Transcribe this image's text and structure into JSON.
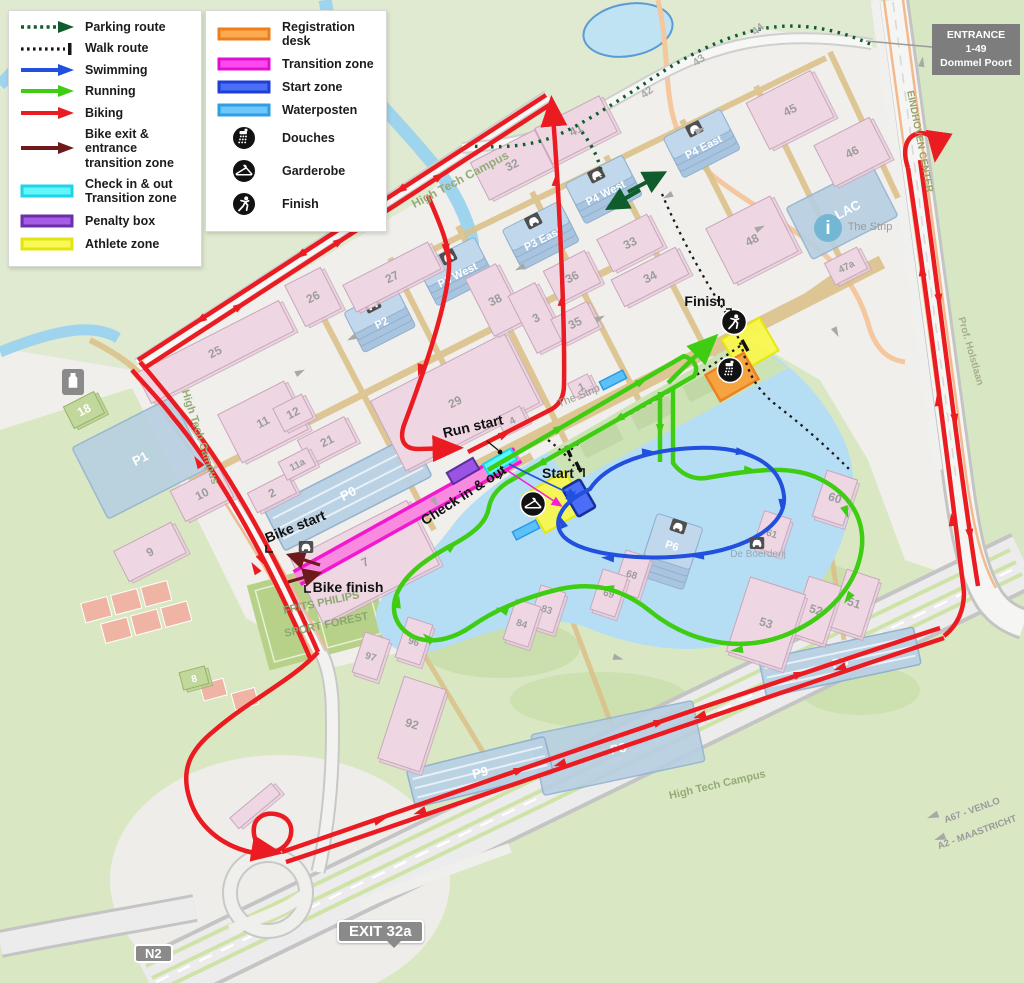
{
  "legend_left": {
    "items": [
      {
        "label": "Parking route",
        "sw": "dotted-arrow",
        "color": "#0f5c2d"
      },
      {
        "label": "Walk route",
        "sw": "dotted-bar",
        "color": "#161616"
      },
      {
        "label": "Swimming",
        "sw": "arrow",
        "color": "#2050dd"
      },
      {
        "label": "Running",
        "sw": "arrow",
        "color": "#3ecd12"
      },
      {
        "label": "Biking",
        "sw": "arrow",
        "color": "#ea1c22"
      },
      {
        "label": "Bike exit & entrance",
        "label2": "transition zone",
        "sw": "arrow",
        "color": "#6e1a1c"
      },
      {
        "label": "Check in & out",
        "label2": "Transition zone",
        "sw": "bar",
        "color": "#63f6f9",
        "border": "#1fd3ea"
      },
      {
        "label": "Penalty box",
        "sw": "bar",
        "color": "#a55ce6",
        "border": "#6b2fa8"
      },
      {
        "label": "Athlete zone",
        "sw": "bar",
        "color": "#f9f955",
        "border": "#e4e410"
      }
    ]
  },
  "legend_right": {
    "items": [
      {
        "label": "Registration desk",
        "sw": "bar",
        "color": "#fbaa4e",
        "border": "#f07d1d"
      },
      {
        "label": "Transition zone",
        "sw": "bar",
        "color": "#fb49ef",
        "border": "#e00fd0"
      },
      {
        "label": "Start zone",
        "sw": "bar",
        "color": "#4a6ef5",
        "border": "#1f3ed6"
      },
      {
        "label": "Waterposten",
        "sw": "bar",
        "color": "#6ec6fa",
        "border": "#2f9fe3"
      },
      {
        "label": "Douches",
        "sw": "icon",
        "icon": "shower"
      },
      {
        "label": "Garderobe",
        "sw": "icon",
        "icon": "hanger"
      },
      {
        "label": "Finish",
        "sw": "icon",
        "icon": "runner"
      }
    ]
  },
  "signs": {
    "entrance_line1": "ENTRANCE",
    "entrance_line2": "1-49",
    "entrance_line3": "Dommel Poort",
    "exit": "EXIT 32a",
    "n2": "N2"
  },
  "map": {
    "labels": [
      {
        "t": "High Tech Campus",
        "x": 462,
        "y": 183,
        "r": -28,
        "s": 12,
        "c": "#94ab76",
        "w": 700
      },
      {
        "t": "High Tech Campus",
        "x": 197,
        "y": 438,
        "r": 72,
        "s": 11,
        "c": "#94ab76",
        "w": 700
      },
      {
        "t": "High Tech Campus",
        "x": 718,
        "y": 788,
        "r": -13,
        "s": 11,
        "c": "#94ab76",
        "w": 700
      },
      {
        "t": "The Strip",
        "x": 870,
        "y": 230,
        "r": 0,
        "s": 11,
        "c": "#9a9a9a",
        "w": 400
      },
      {
        "t": "The Strip",
        "x": 580,
        "y": 399,
        "r": -22,
        "s": 11,
        "c": "#9a9a9a",
        "w": 400
      },
      {
        "t": "De Boerderij",
        "x": 758,
        "y": 557,
        "r": 0,
        "s": 10,
        "c": "#97a8b4",
        "w": 400
      },
      {
        "t": "FRITS PHILIPS",
        "x": 322,
        "y": 606,
        "r": -12,
        "s": 11,
        "c": "#8ca671",
        "w": 700
      },
      {
        "t": "SPORT FOREST",
        "x": 327,
        "y": 628,
        "r": -12,
        "s": 11,
        "c": "#8ca671",
        "w": 700
      },
      {
        "t": "EINDHOVEN CENTER",
        "x": 917,
        "y": 142,
        "r": 79,
        "s": 10,
        "c": "#93a56b",
        "w": 700
      },
      {
        "t": "Prof. Holstlaan",
        "x": 968,
        "y": 352,
        "r": 74,
        "s": 10,
        "c": "#a8ad8f",
        "w": 700
      },
      {
        "t": "A67 - VENLO",
        "x": 973,
        "y": 813,
        "r": -20,
        "s": 9.5,
        "c": "#9a9a9a",
        "w": 700
      },
      {
        "t": "A2 - MAASTRICHT",
        "x": 978,
        "y": 835,
        "r": -20,
        "s": 9.5,
        "c": "#9a9a9a",
        "w": 700
      },
      {
        "t": "42",
        "x": 649,
        "y": 95,
        "r": -38,
        "s": 11,
        "c": "#a8a8a8",
        "w": 700
      },
      {
        "t": "43",
        "x": 701,
        "y": 63,
        "r": -38,
        "s": 11,
        "c": "#a8a8a8",
        "w": 700
      },
      {
        "t": "44",
        "x": 760,
        "y": 32,
        "r": -38,
        "s": 11,
        "c": "#a8a8a8",
        "w": 700
      },
      {
        "t": "Run start",
        "x": 474,
        "y": 431,
        "r": -13,
        "s": 14,
        "c": "#111111",
        "w": 600
      },
      {
        "t": "Check in & out",
        "x": 466,
        "y": 499,
        "r": -33,
        "s": 14,
        "c": "#111111",
        "w": 600
      },
      {
        "t": "Start",
        "x": 558,
        "y": 478,
        "r": 0,
        "s": 14,
        "c": "#111111",
        "w": 600
      },
      {
        "t": "Bike start",
        "x": 297,
        "y": 531,
        "r": -22,
        "s": 14,
        "c": "#111111",
        "w": 600
      },
      {
        "t": "Bike finish",
        "x": 348,
        "y": 592,
        "r": 0,
        "s": 14,
        "c": "#111111",
        "w": 600
      },
      {
        "t": "Finish",
        "x": 705,
        "y": 306,
        "r": 0,
        "s": 14,
        "c": "#111111",
        "w": 600
      }
    ],
    "buildings": [
      {
        "n": "25",
        "x": 215,
        "y": 352,
        "w": 160,
        "h": 34,
        "r": -27
      },
      {
        "n": "26",
        "x": 313,
        "y": 297,
        "w": 40,
        "h": 46,
        "r": -27
      },
      {
        "n": "27",
        "x": 392,
        "y": 277,
        "w": 95,
        "h": 30,
        "r": -27
      },
      {
        "n": "29",
        "x": 455,
        "y": 402,
        "w": 150,
        "h": 78,
        "r": -27
      },
      {
        "n": "38",
        "x": 495,
        "y": 300,
        "w": 34,
        "h": 64,
        "r": -27
      },
      {
        "n": "3",
        "x": 536,
        "y": 318,
        "w": 30,
        "h": 64,
        "r": -27
      },
      {
        "n": "32",
        "x": 512,
        "y": 165,
        "w": 72,
        "h": 42,
        "r": -27
      },
      {
        "n": "41",
        "x": 576,
        "y": 130,
        "w": 72,
        "h": 40,
        "r": -27
      },
      {
        "n": "33",
        "x": 630,
        "y": 243,
        "w": 56,
        "h": 36,
        "r": -27
      },
      {
        "n": "34",
        "x": 650,
        "y": 277,
        "w": 72,
        "h": 30,
        "r": -27
      },
      {
        "n": "36",
        "x": 572,
        "y": 277,
        "w": 46,
        "h": 36,
        "r": -27
      },
      {
        "n": "35",
        "x": 575,
        "y": 323,
        "w": 40,
        "h": 28,
        "r": -27
      },
      {
        "n": "45",
        "x": 790,
        "y": 110,
        "w": 72,
        "h": 52,
        "r": -27
      },
      {
        "n": "46",
        "x": 852,
        "y": 152,
        "w": 62,
        "h": 46,
        "r": -27
      },
      {
        "n": "48",
        "x": 752,
        "y": 240,
        "w": 72,
        "h": 62,
        "r": -27
      },
      {
        "n": "47a",
        "x": 846,
        "y": 266,
        "w": 36,
        "h": 24,
        "r": -27
      },
      {
        "n": "1",
        "x": 581,
        "y": 386,
        "w": 22,
        "h": 16,
        "r": -27
      },
      {
        "n": "4",
        "x": 512,
        "y": 420,
        "w": 26,
        "h": 18,
        "r": -27
      },
      {
        "n": "7",
        "x": 365,
        "y": 562,
        "w": 130,
        "h": 72,
        "r": -27
      },
      {
        "n": "2",
        "x": 272,
        "y": 493,
        "w": 44,
        "h": 22,
        "r": -27
      },
      {
        "n": "10",
        "x": 202,
        "y": 494,
        "w": 54,
        "h": 34,
        "r": -27
      },
      {
        "n": "9",
        "x": 150,
        "y": 552,
        "w": 64,
        "h": 34,
        "r": -27
      },
      {
        "n": "11",
        "x": 263,
        "y": 422,
        "w": 74,
        "h": 54,
        "r": -27
      },
      {
        "n": "12",
        "x": 293,
        "y": 413,
        "w": 32,
        "h": 26,
        "r": -27
      },
      {
        "n": "21",
        "x": 327,
        "y": 441,
        "w": 52,
        "h": 28,
        "r": -27
      },
      {
        "n": "11a",
        "x": 297,
        "y": 464,
        "w": 32,
        "h": 20,
        "r": -27
      },
      {
        "n": "18",
        "x": 84,
        "y": 410,
        "w": 34,
        "h": 24,
        "r": -27,
        "k": "green"
      },
      {
        "n": "8",
        "x": 194,
        "y": 678,
        "w": 26,
        "h": 18,
        "r": -15,
        "k": "green"
      },
      {
        "n": "51",
        "x": 854,
        "y": 603,
        "w": 34,
        "h": 60,
        "r": 18
      },
      {
        "n": "52",
        "x": 816,
        "y": 610,
        "w": 34,
        "h": 60,
        "r": 18
      },
      {
        "n": "53",
        "x": 766,
        "y": 623,
        "w": 58,
        "h": 78,
        "r": 18
      },
      {
        "n": "60",
        "x": 835,
        "y": 498,
        "w": 32,
        "h": 48,
        "r": 18
      },
      {
        "n": "61",
        "x": 772,
        "y": 533,
        "w": 28,
        "h": 38,
        "r": 18
      },
      {
        "n": "68",
        "x": 632,
        "y": 574,
        "w": 26,
        "h": 42,
        "r": 18
      },
      {
        "n": "69",
        "x": 609,
        "y": 593,
        "w": 26,
        "h": 42,
        "r": 18
      },
      {
        "n": "83",
        "x": 547,
        "y": 609,
        "w": 26,
        "h": 42,
        "r": 18
      },
      {
        "n": "84",
        "x": 522,
        "y": 623,
        "w": 26,
        "h": 42,
        "r": 18
      },
      {
        "n": "96",
        "x": 414,
        "y": 641,
        "w": 26,
        "h": 42,
        "r": 18
      },
      {
        "n": "97",
        "x": 371,
        "y": 656,
        "w": 26,
        "h": 42,
        "r": 18
      },
      {
        "n": "92",
        "x": 412,
        "y": 724,
        "w": 44,
        "h": 86,
        "r": 18
      },
      {
        "n": "",
        "x": 255,
        "y": 806,
        "w": 54,
        "h": 14,
        "r": -40
      }
    ],
    "parkings": [
      {
        "n": "P1",
        "x": 140,
        "y": 458,
        "w": 112,
        "h": 80,
        "r": -27,
        "k": "flat"
      },
      {
        "n": "P0",
        "x": 348,
        "y": 493,
        "w": 165,
        "h": 46,
        "r": -27,
        "k": "stripe"
      },
      {
        "n": "P LAC",
        "x": 842,
        "y": 212,
        "w": 96,
        "h": 58,
        "r": -27,
        "k": "flat"
      },
      {
        "n": "P8",
        "x": 618,
        "y": 748,
        "w": 165,
        "h": 62,
        "r": -12,
        "k": "flat"
      },
      {
        "n": "P2",
        "x": 380,
        "y": 320,
        "w": 58,
        "h": 46,
        "r": -27,
        "k": "garage"
      },
      {
        "n": "P3 West",
        "x": 456,
        "y": 272,
        "w": 64,
        "h": 46,
        "r": -27,
        "k": "garage"
      },
      {
        "n": "P3 East",
        "x": 541,
        "y": 236,
        "w": 64,
        "h": 46,
        "r": -27,
        "k": "garage"
      },
      {
        "n": "P4 West",
        "x": 604,
        "y": 190,
        "w": 64,
        "h": 46,
        "r": -27,
        "k": "garage"
      },
      {
        "n": "P4 East",
        "x": 702,
        "y": 144,
        "w": 64,
        "h": 46,
        "r": -27,
        "k": "garage"
      },
      {
        "n": "P6",
        "x": 670,
        "y": 552,
        "w": 48,
        "h": 66,
        "r": 18,
        "k": "garage"
      },
      {
        "n": "P5",
        "x": 840,
        "y": 662,
        "w": 158,
        "h": 38,
        "r": -12,
        "k": "stripe"
      },
      {
        "n": "P9",
        "x": 480,
        "y": 772,
        "w": 142,
        "h": 38,
        "r": -14,
        "k": "stripe"
      }
    ],
    "icons": [
      {
        "k": "finish",
        "x": 734,
        "y": 322
      },
      {
        "k": "douches",
        "x": 730,
        "y": 370
      },
      {
        "k": "garderobe",
        "x": 533,
        "y": 504
      },
      {
        "k": "info",
        "x": 828,
        "y": 228
      },
      {
        "k": "poi",
        "x": 73,
        "y": 382
      },
      {
        "k": "car",
        "x": 757,
        "y": 543
      },
      {
        "k": "car",
        "x": 306,
        "y": 547
      }
    ]
  }
}
